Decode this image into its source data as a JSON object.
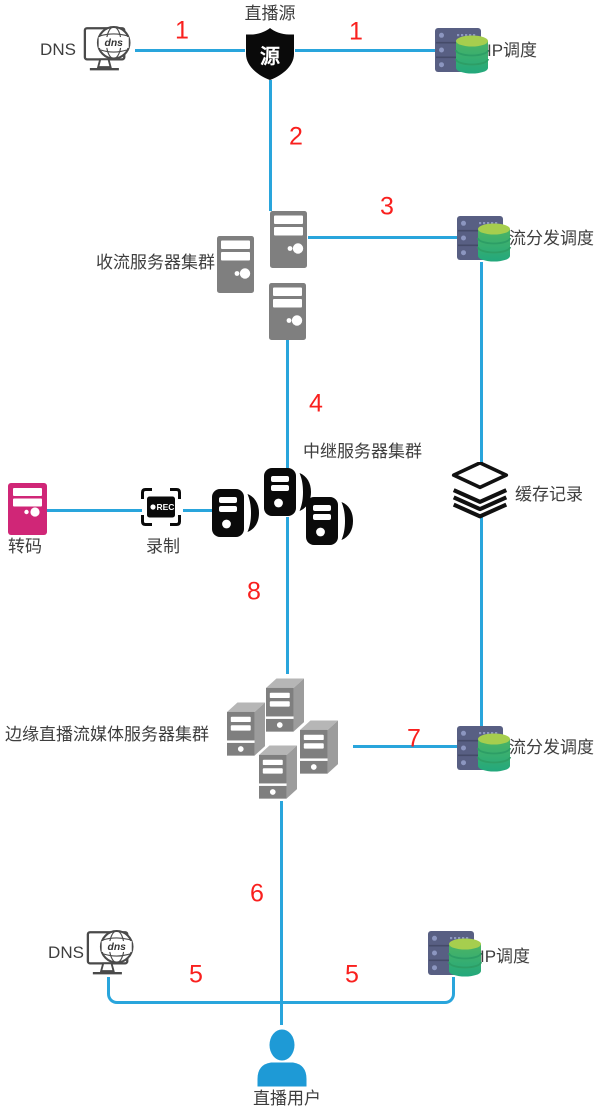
{
  "canvas": {
    "width": 606,
    "height": 1113,
    "background": "#ffffff"
  },
  "colors": {
    "connector_blue": "#29A5DC",
    "step_red": "#F9201E",
    "label_gray": "#3E3E3E",
    "rack_navy": "#585F83",
    "database_green_top": "#A6CE4E",
    "database_green_body": "#3FB065",
    "server_gray": "#7F7F7F",
    "transcode_magenta": "#D02677",
    "icon_black": "#0A0A0A",
    "user_blue": "#1E9AD6"
  },
  "nodes": {
    "live_source": {
      "label": "直播源",
      "icon_text": "源"
    },
    "dns_top": {
      "label": "DNS",
      "icon_text": "dns"
    },
    "ip_sched_top": {
      "label": "IP调度"
    },
    "ingest_cluster": {
      "label": "收流服务器集群"
    },
    "dispatch_top": {
      "label": "流分发调度"
    },
    "relay_cluster": {
      "label": "中继服务器集群"
    },
    "cache": {
      "label": "缓存记录"
    },
    "transcode": {
      "label": "转码"
    },
    "record": {
      "label": "录制",
      "icon_text": "REC"
    },
    "edge_cluster": {
      "label": "边缘直播流媒体服务器集群"
    },
    "dispatch_bottom": {
      "label": "流分发调度"
    },
    "dns_bottom": {
      "label": "DNS"
    },
    "ip_sched_bottom": {
      "label": "IP调度"
    },
    "user": {
      "label": "直播用户"
    }
  },
  "steps": {
    "dns_to_source": "1",
    "source_to_ip": "1",
    "source_to_ingest": "2",
    "ingest_to_dispatch": "3",
    "ingest_to_relay": "4",
    "user_to_dns": "5",
    "user_to_ip": "5",
    "user_to_edge": "6",
    "edge_to_dispatch": "7",
    "relay_to_edge": "8"
  }
}
